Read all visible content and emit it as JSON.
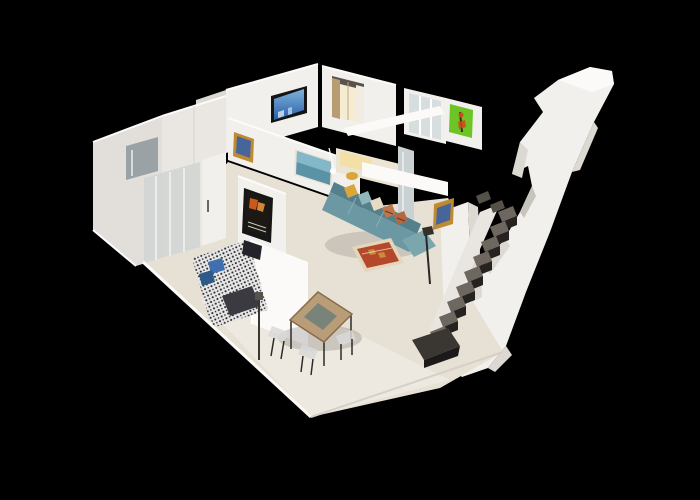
{
  "scene": {
    "description_elements": [
      "apartment-dollhouse-model",
      "wall-mounted-tv",
      "curtained-window",
      "kitchen-counter",
      "green-artwork",
      "blue-seascape-artwork",
      "gold-framed-pictures",
      "movie-poster",
      "bathroom-glass-shower",
      "patterned-double-bed",
      "blue-pillows",
      "dining-table-with-chairs",
      "teal-l-shaped-sofa",
      "throw-pillows",
      "kilim-rug",
      "floor-lamps",
      "dark-staircase",
      "cutaway-roof-structure"
    ],
    "colors": {
      "background": "#000000",
      "wall": "#f2f0ec",
      "wall_bright": "#fbfaf8",
      "wall_shade": "#dcd9d3",
      "floor": "#e7e1d5",
      "floor_bright": "#f1ede4",
      "floor_edge": "#fbfaf7",
      "floor_edge_right": "#d5d1c8",
      "bath_glass": "#d2d5d3",
      "bath_mirror": "#9aa2a6",
      "hall_wall": "#eae7e2",
      "bath_wall": "#e2dfda",
      "sofa": "#6b98a2",
      "sofa_dark": "#54808c",
      "sofa_light": "#7ca6ae",
      "pillow_yellow": "#d9a63b",
      "pillow_teal": "#8fb6ba",
      "pillow_cream": "#e6dcc4",
      "pillow_kilim": "#c0764a",
      "pillow_kilim2": "#b5683f",
      "pillow_blue": "#3f6fb0",
      "pillow_blue2": "#2e5a8a",
      "rug_border": "#e3d6ba",
      "rug_red": "#b5482a",
      "rug_orange": "#cc8a3c",
      "bed_base": "#e8e8e8",
      "bed_dots": "#2b2b2b",
      "bed_dark": "#3a3a40",
      "headboard_tv": "#23232a",
      "table_wood": "#b99d78",
      "table_edge": "#8a6a4a",
      "table_glass": "#79837a",
      "chair_seat": "#d8d8d8",
      "metal_dark": "#2e2b28",
      "stair_top": "#6e6760",
      "stair_front": "#26221f",
      "stair_box": "#1c1a18",
      "tv_frame": "#141414",
      "tv_blue": "#2a5fa8",
      "tv_blue_light": "#7fb2dc",
      "art_green": "#6cc427",
      "art_orange": "#d04818",
      "art_blue": "#5b93a6",
      "art_blue_light": "#8fc0cf",
      "frame_gold": "#c08a30",
      "pic_blue": "#46659a",
      "poster_frame": "#161616",
      "poster_bg": "#1c1814",
      "poster_flame": "#c85a20",
      "poster_flame2": "#e8903c",
      "window_glow": "#f6ecd2",
      "curtain_tan": "#b79d74",
      "window_bar": "#5a5248",
      "pane": "#d7dee0",
      "kitchen_glow": "#f4df9f",
      "kitchen_mirror": "#c9d1d3"
    }
  }
}
